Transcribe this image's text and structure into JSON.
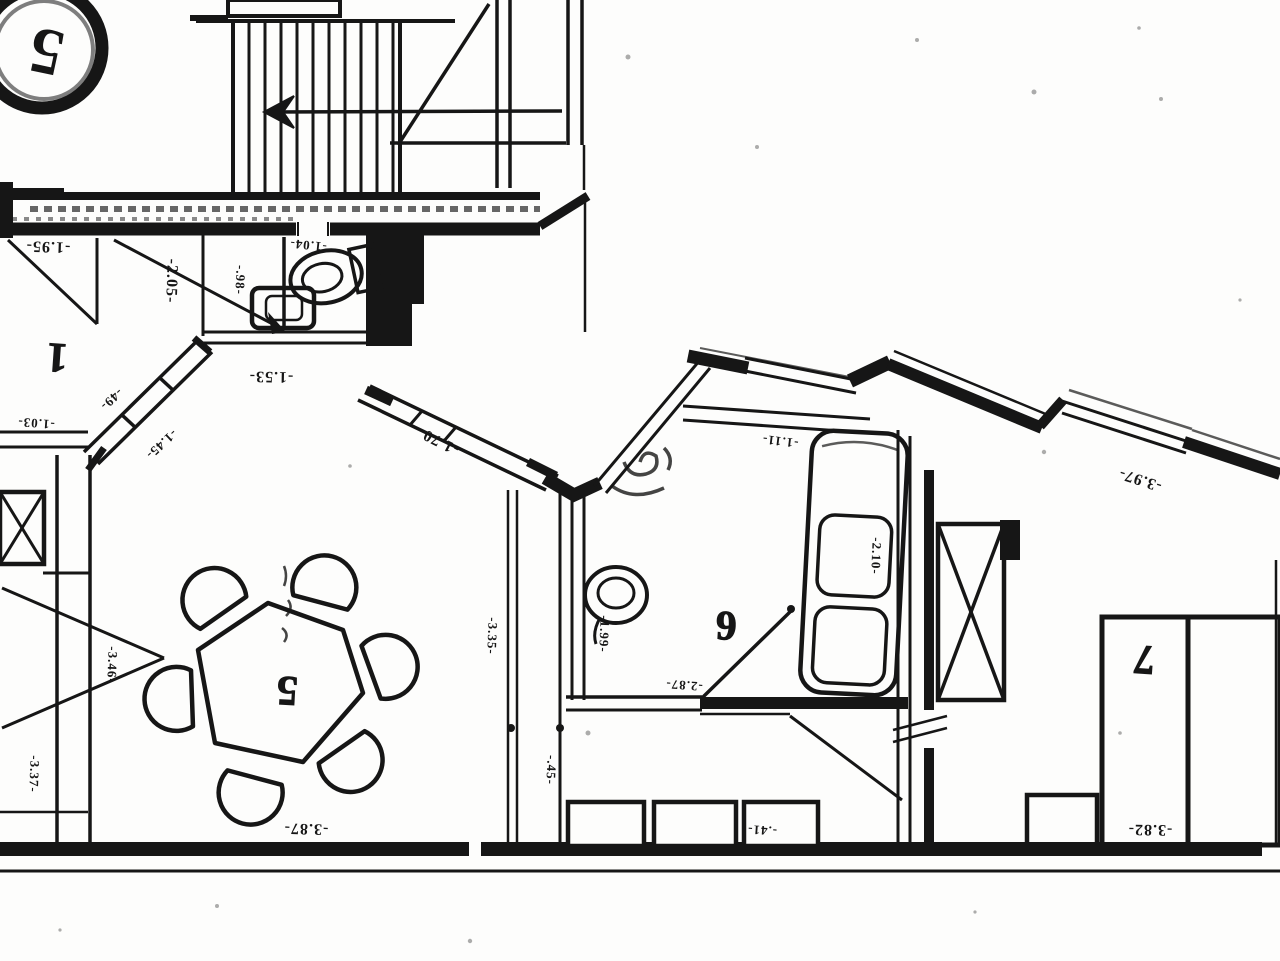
{
  "plan": {
    "title": "scanned floor plan (rotated 180°)",
    "stair_circle_label": "5",
    "room_labels": {
      "room1": "1",
      "room5": "5",
      "room6": "6",
      "room7": "7"
    },
    "dims": {
      "d195": "-1.95-",
      "d205": "-2.05-",
      "d104": "-1.04-",
      "d098": "-.98-",
      "d153": "-1.53-",
      "d103": "-1.03-",
      "d049": "-49-",
      "d145": "-1.45-",
      "d170": "-1.70-",
      "d111": "-1.11-",
      "d397": "-3.97-",
      "d199": "-1.99-",
      "d287": "-2.87-",
      "d210": "-2.10-",
      "d335": "-3.35-",
      "d346": "-3.46-",
      "d337": "-3.37-",
      "d387": "-3.87-",
      "d382": "-3.82-",
      "d045": "-.45-",
      "d041": "-.41-"
    },
    "colors": {
      "ink": "#161616",
      "paper": "#fdfdfc"
    }
  }
}
